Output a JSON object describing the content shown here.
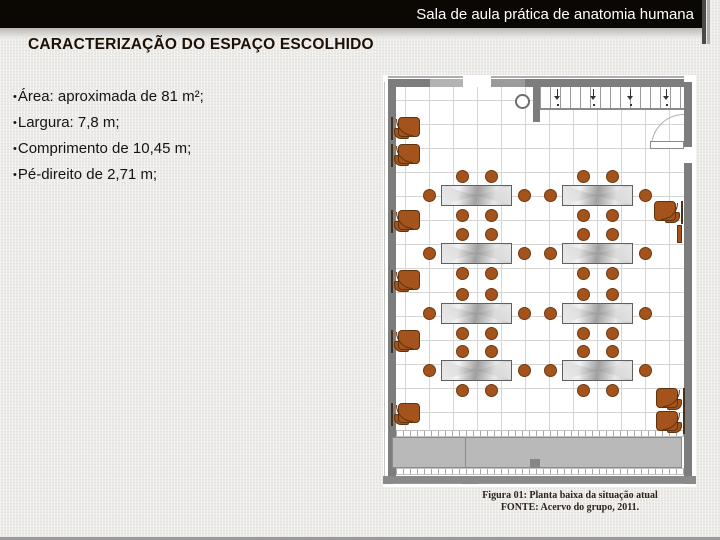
{
  "slide": {
    "title_bar": "Sala de aula prática de anatomia humana",
    "heading": "CARACTERIZAÇÃO DO ESPAÇO ESCOLHIDO",
    "bullet_char": "•",
    "bullets": [
      "Área: aproximada de 81 m²;",
      "Largura: 7,8 m;",
      "Comprimento de 10,45 m;",
      "Pé-direito de 2,71 m;"
    ],
    "caption": {
      "line1": "Figura 01: Planta baixa da situação atual",
      "line2": "FONTE: Acervo do grupo, 2011."
    }
  },
  "colors": {
    "title_bar_bg": "#0b0804",
    "title_text": "#ffffff",
    "heading_text": "#1d1005",
    "body_text": "#141414",
    "caption_text": "#2e2417",
    "stool_brown": "#a4531d",
    "stool_border": "#6f3910",
    "wall_gray": "#7d7d7d",
    "counter_gray": "#b9b9b9",
    "slide_bg": "#ebeae7"
  },
  "floor_plan": {
    "tables": {
      "col_x": [
        58,
        179
      ],
      "row_y": [
        110,
        168,
        228,
        285
      ],
      "w": 71,
      "h": 21
    },
    "stool_offsets": [
      [
        21,
        -9
      ],
      [
        50,
        -9
      ],
      [
        21,
        30
      ],
      [
        50,
        30
      ],
      [
        -12,
        10
      ],
      [
        83,
        10
      ]
    ],
    "stool_d": 13,
    "left_unit_x": 10,
    "left_units_y": [
      41,
      68,
      134,
      194,
      254,
      327
    ],
    "right_units": [
      {
        "x": 270,
        "y": 125,
        "type": "unit"
      },
      {
        "x": 272,
        "y": 312,
        "type": "unit"
      },
      {
        "x": 272,
        "y": 335,
        "type": "unit"
      },
      {
        "x": 294,
        "y": 150,
        "type": "strip"
      }
    ],
    "window_arrows_x": [
      14,
      50,
      87,
      123
    ]
  }
}
